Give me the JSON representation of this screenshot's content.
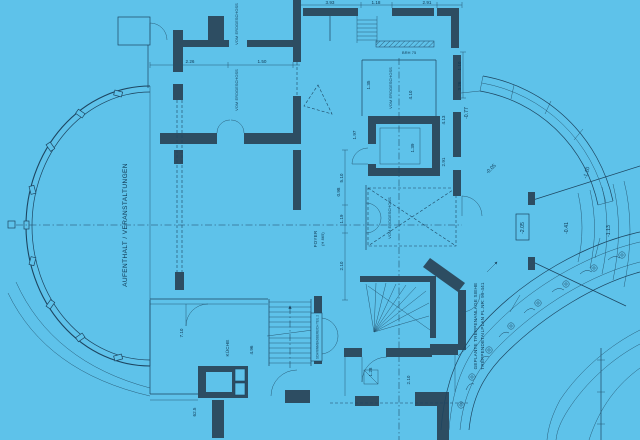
{
  "colors": {
    "background": "#5ec2ea",
    "wall": "#2d4d62",
    "line": "#1d4560",
    "text": "#0e3752"
  },
  "rooms": {
    "hall": "AUFENTHALT / VERANSTALTUNGEN",
    "foyer": "FOYER",
    "foyer_height": "(H 865)",
    "kitchen": "KÜCHE",
    "from_ground_1": "VOM ERDGESCHOSS",
    "from_ground_2": "VOM ERDGESCHOSS",
    "from_ground_3": "VOM ERDGESCHOSS",
    "from_ground_4": "VOM ERDGESCHOSS"
  },
  "notes": {
    "pool": "SCHWIMMBADBEREICH TEIL 2",
    "stair_line1": "GEPLANTE TREPPENANLAGE SIEHE",
    "stair_line2": "TREPPENDETAILPLAN PL.NR: 99-441",
    "parapet": "BRH 75"
  },
  "levels": {
    "l1": "-2.05",
    "l2": "-0.41",
    "l3": "-1.13",
    "l4": "-0.77",
    "l5": "-1.10",
    "l6": "-0.05"
  },
  "dims": {
    "d1": "1.35",
    "d2": "4.10",
    "d3": "4.13",
    "d4": "2.91",
    "d5": "1.39",
    "d6": "1.97",
    "d7": "1.10",
    "d8": "3.26",
    "d9": "3.93",
    "d10": "1.18",
    "d11": "2.91",
    "d12": "1.19",
    "d13": "2.10",
    "d14": "7.10",
    "d15": "4.96",
    "d16": "62.5",
    "d17": "2.10",
    "d18": "1.28",
    "d19": "5.10",
    "d20": "0.98",
    "d21": "2.26",
    "d22": "1.50"
  }
}
